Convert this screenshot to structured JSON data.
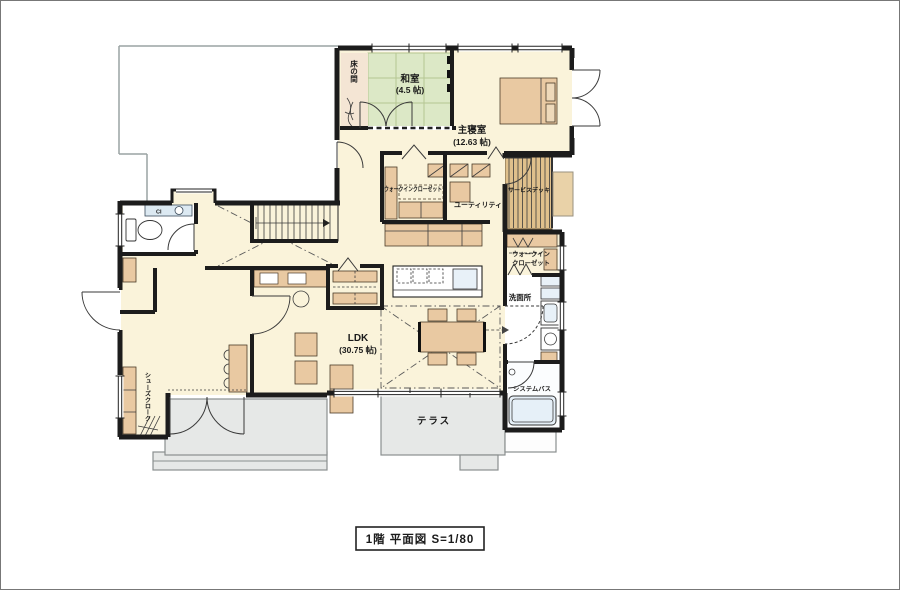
{
  "plan": {
    "caption": "1階 平面図 S=1/80"
  },
  "rooms": {
    "washitsu": {
      "name": "和室",
      "size": "(4.5 帖)"
    },
    "tokonoma": {
      "name": "床の間"
    },
    "master": {
      "name": "主寝室",
      "size": "(12.63 帖)"
    },
    "wic1": {
      "name": "ウォークインクローゼット"
    },
    "utility": {
      "name": "ユーティリティ"
    },
    "deck": {
      "name": "サービスデッキ"
    },
    "wic2": {
      "line1": "ウォークイン",
      "line2": "クローゼット"
    },
    "washroom": {
      "name": "洗面所"
    },
    "bath": {
      "name": "システムバス"
    },
    "ldk": {
      "name": "LDK",
      "size": "(30.75 帖)"
    },
    "terrace": {
      "name": "テラス"
    },
    "shoes": {
      "name": "シューズクローク"
    },
    "toilet": {
      "counter_mark": "CI"
    }
  },
  "colors": {
    "wall": "#1c1c1c",
    "floor_cream": "#faf3da",
    "tatami_green": "#dce8c6",
    "tokonoma_beige": "#f4e5d4",
    "deck_wood": "#dfc08c",
    "exterior_gray": "#e6e8e7",
    "fixture_blue": "#e8f1f8"
  }
}
